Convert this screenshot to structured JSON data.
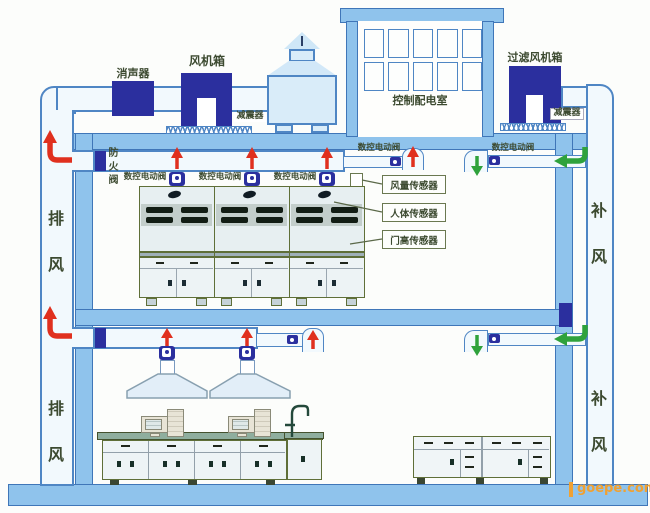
{
  "colors": {
    "navy": "#2b2f9e",
    "red": "#e0301e",
    "green": "#2fa23c",
    "ductB": "#4f86c4",
    "ductF": "#f2f9fd",
    "wall": "#8fc3ec",
    "wallB": "#3f76b8",
    "text": "#3c4a30",
    "olive": "#5f6f38",
    "wm": "#f0a132"
  },
  "roof": {
    "silencer": "消声器",
    "fan_box": "风机箱",
    "vibration_damper": "减震器",
    "control_room": "控制配电室",
    "filter_fan_box": "过滤风机箱"
  },
  "risers": {
    "exhaust": "排风",
    "supply": "补风"
  },
  "floor_upper": {
    "fire_damper": "防火阀",
    "cnc_valve": "数控电动阀",
    "sensors": [
      "风量传感器",
      "人体传感器",
      "门高传感器"
    ]
  },
  "icons": {
    "red-up-arrow": "exhaust airflow up",
    "green-down-arrow": "supply airflow down",
    "red-elbow-arrow": "exhaust riser flow",
    "green-elbow-arrow": "supply branch flow",
    "valve-actuator-icon": "motorized valve",
    "springs-icon": "vibration mounts"
  },
  "watermark": "goepe.com"
}
